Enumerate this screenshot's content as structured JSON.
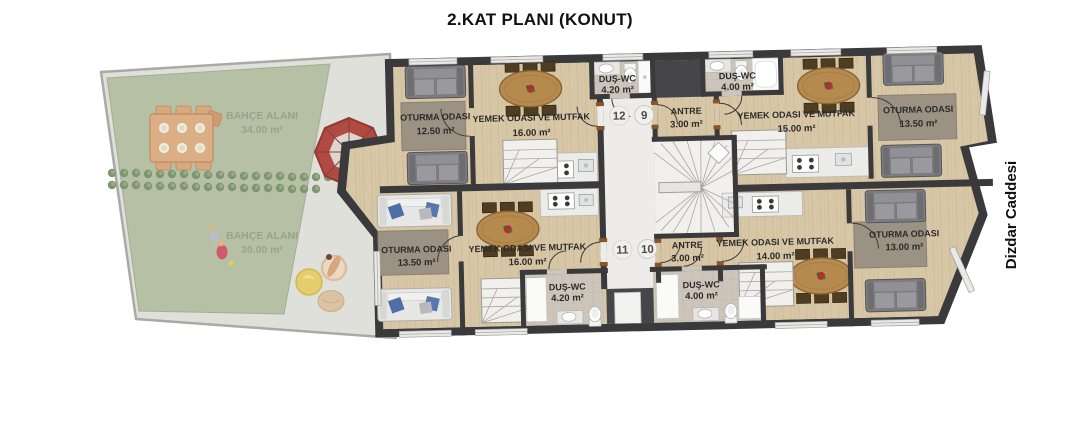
{
  "title": "2.KAT PLANI (KONUT)",
  "street": "Dizdar Caddesi",
  "garden": {
    "upper": {
      "name": "BAHÇE ALANI",
      "size": "34.00 m²"
    },
    "lower": {
      "name": "BAHÇE ALANI",
      "size": "30.00 m²"
    }
  },
  "units": {
    "upper_numbers": {
      "left": "12",
      "right": "9"
    },
    "lower_numbers": {
      "left": "11",
      "right": "10"
    }
  },
  "rooms": {
    "tl_living": {
      "name": "OTURMA ODASI",
      "size": "12.50 m²"
    },
    "tl_dining": {
      "name": "YEMEK ODASI VE MUTFAK",
      "size": "16.00 m²"
    },
    "tl_bath": {
      "name": "DUŞ-WC",
      "size": "4.20 m²"
    },
    "t_antre": {
      "name": "ANTRE",
      "size": "3.00 m²"
    },
    "tr_bath": {
      "name": "DUŞ-WC",
      "size": "4.00 m²"
    },
    "tr_dining": {
      "name": "YEMEK ODASI VE MUTFAK",
      "size": "15.00 m²"
    },
    "tr_living": {
      "name": "OTURMA ODASI",
      "size": "13.50 m²"
    },
    "bl_living": {
      "name": "OTURMA ODASI",
      "size": "13.50 m²"
    },
    "bl_dining": {
      "name": "YEMEK ODASI VE MUTFAK",
      "size": "16.00 m²"
    },
    "bl_bath": {
      "name": "DUŞ-WC",
      "size": "4.20 m²"
    },
    "b_antre": {
      "name": "ANTRE",
      "size": "3.00 m²"
    },
    "br_bath": {
      "name": "DUŞ-WC",
      "size": "4.00 m²"
    },
    "br_dining": {
      "name": "YEMEK ODASI VE MUTFAK",
      "size": "14.00 m²"
    },
    "br_living": {
      "name": "OTURMA ODASI",
      "size": "13.00 m²"
    }
  },
  "colors": {
    "wall": "#3a3a3c",
    "wood_floor": "#d8c7a6",
    "grass": "#b6c0a5",
    "paving": "#e0e0db",
    "corridor_floor": "#edece8",
    "bath_floor": "#cdc5b9",
    "stair_floor": "#f1f0ec",
    "rug": "#9b9283",
    "sofa_gray": "#86868a",
    "sofa_white": "#e7e7e5",
    "pillow_blue": "#4f6ea8",
    "table_wood": "#b68a4e",
    "label_text": "#2b2b2b",
    "garden_text": "#96a48b",
    "parasol_red": "#b04a42"
  }
}
